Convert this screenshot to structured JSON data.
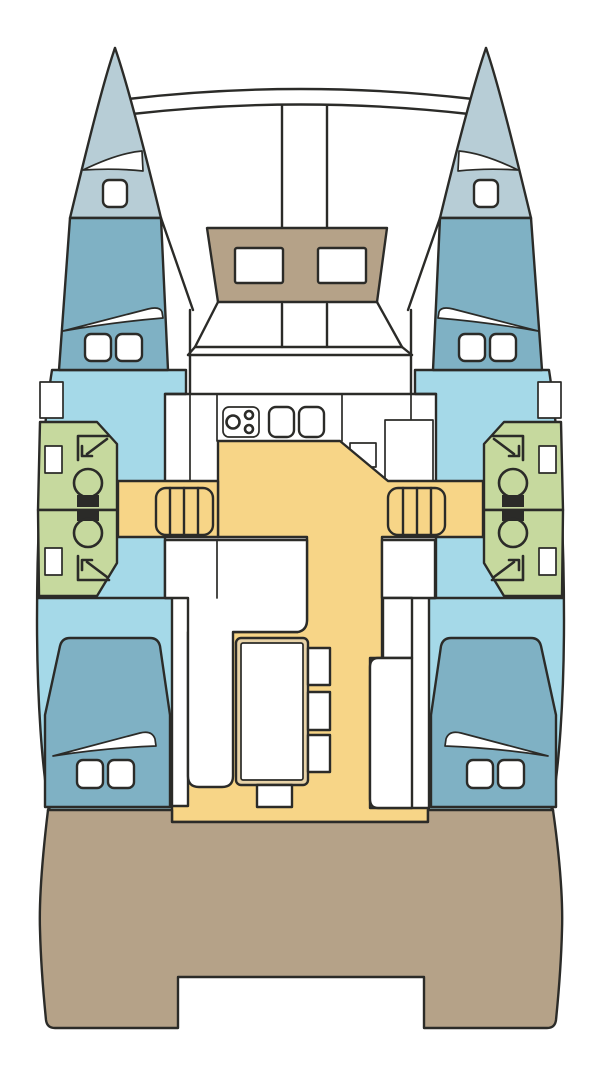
{
  "diagram": {
    "title": "Catamaran interior floor plan, top view, bow up",
    "type": "boat-layout-diagram"
  },
  "colors": {
    "white": "#ffffff",
    "outline": "#2b2b28",
    "bow_deck": "#b7cdd6",
    "berth": "#7fb1c4",
    "cabin_floor": "#a5d9e8",
    "head_compartment": "#c6d99e",
    "saloon_floor": "#f7d587",
    "foredeck_seat": "#b5a288",
    "cockpit_deck": "#b5a288",
    "table_edge": "#e8d3a8"
  },
  "structure": {
    "hulls": 2,
    "bow_hatches": 2,
    "bow_vents": 2,
    "trampoline_beams": 2,
    "anchor_locker_rails": 2,
    "coachroof_windows": 2,
    "forward_berths": 2,
    "aft_berths": 2,
    "pillows_per_berth": 2,
    "head_compartments": 4,
    "toilets": 4,
    "shower_symbols": 4,
    "hull_portholes": 4,
    "companionway_steps": 2,
    "galley_stove_burners": 3,
    "galley_sinks": 2,
    "saloon_side_stools": 3,
    "saloon_end_stools": 1,
    "saloon_sofas": 1,
    "saloon_benches": 1,
    "cockpit_step_notches": 1
  }
}
